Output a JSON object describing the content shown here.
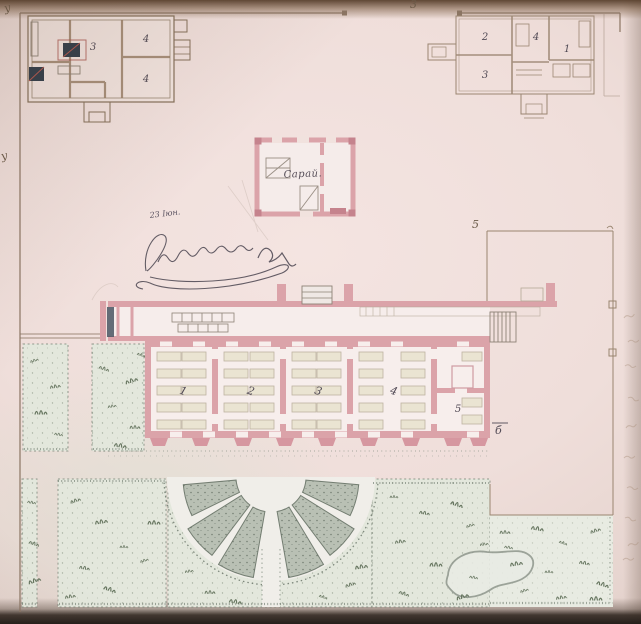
{
  "title": "Ситуационный планъ",
  "colors": {
    "wall_pink": "#dba3a9",
    "wall_pink_dark": "#c5838d",
    "wall_pink_pale": "#ecc3c6",
    "ink_brown": "#8a7360",
    "ink_light": "#a38d77",
    "ink_dark": "#514a55",
    "stove_blue": "#333e4b",
    "paper_room": "#f7eeec",
    "garden_wash": "#e3e7dc",
    "meadow_wash": "#e8ebe2",
    "garden_dark": "#b9c0b4",
    "garden_ink": "#798477",
    "tuft_green": "#66755f"
  },
  "markers": {
    "top_center": "3",
    "top_left": "у",
    "left_edge": "у",
    "yard_corner": "5",
    "main_building_letter": "б"
  },
  "annotation": {
    "date_note": "23 Іюн."
  },
  "shed": {
    "label": "Сарай."
  },
  "outbuilding_nw": {
    "rooms": [
      "3",
      "4",
      "4"
    ]
  },
  "outbuilding_ne": {
    "rooms": [
      "2",
      "4",
      "3",
      "1"
    ]
  },
  "main_building": {
    "rooms": [
      "1",
      "2",
      "3",
      "4",
      "5"
    ]
  }
}
